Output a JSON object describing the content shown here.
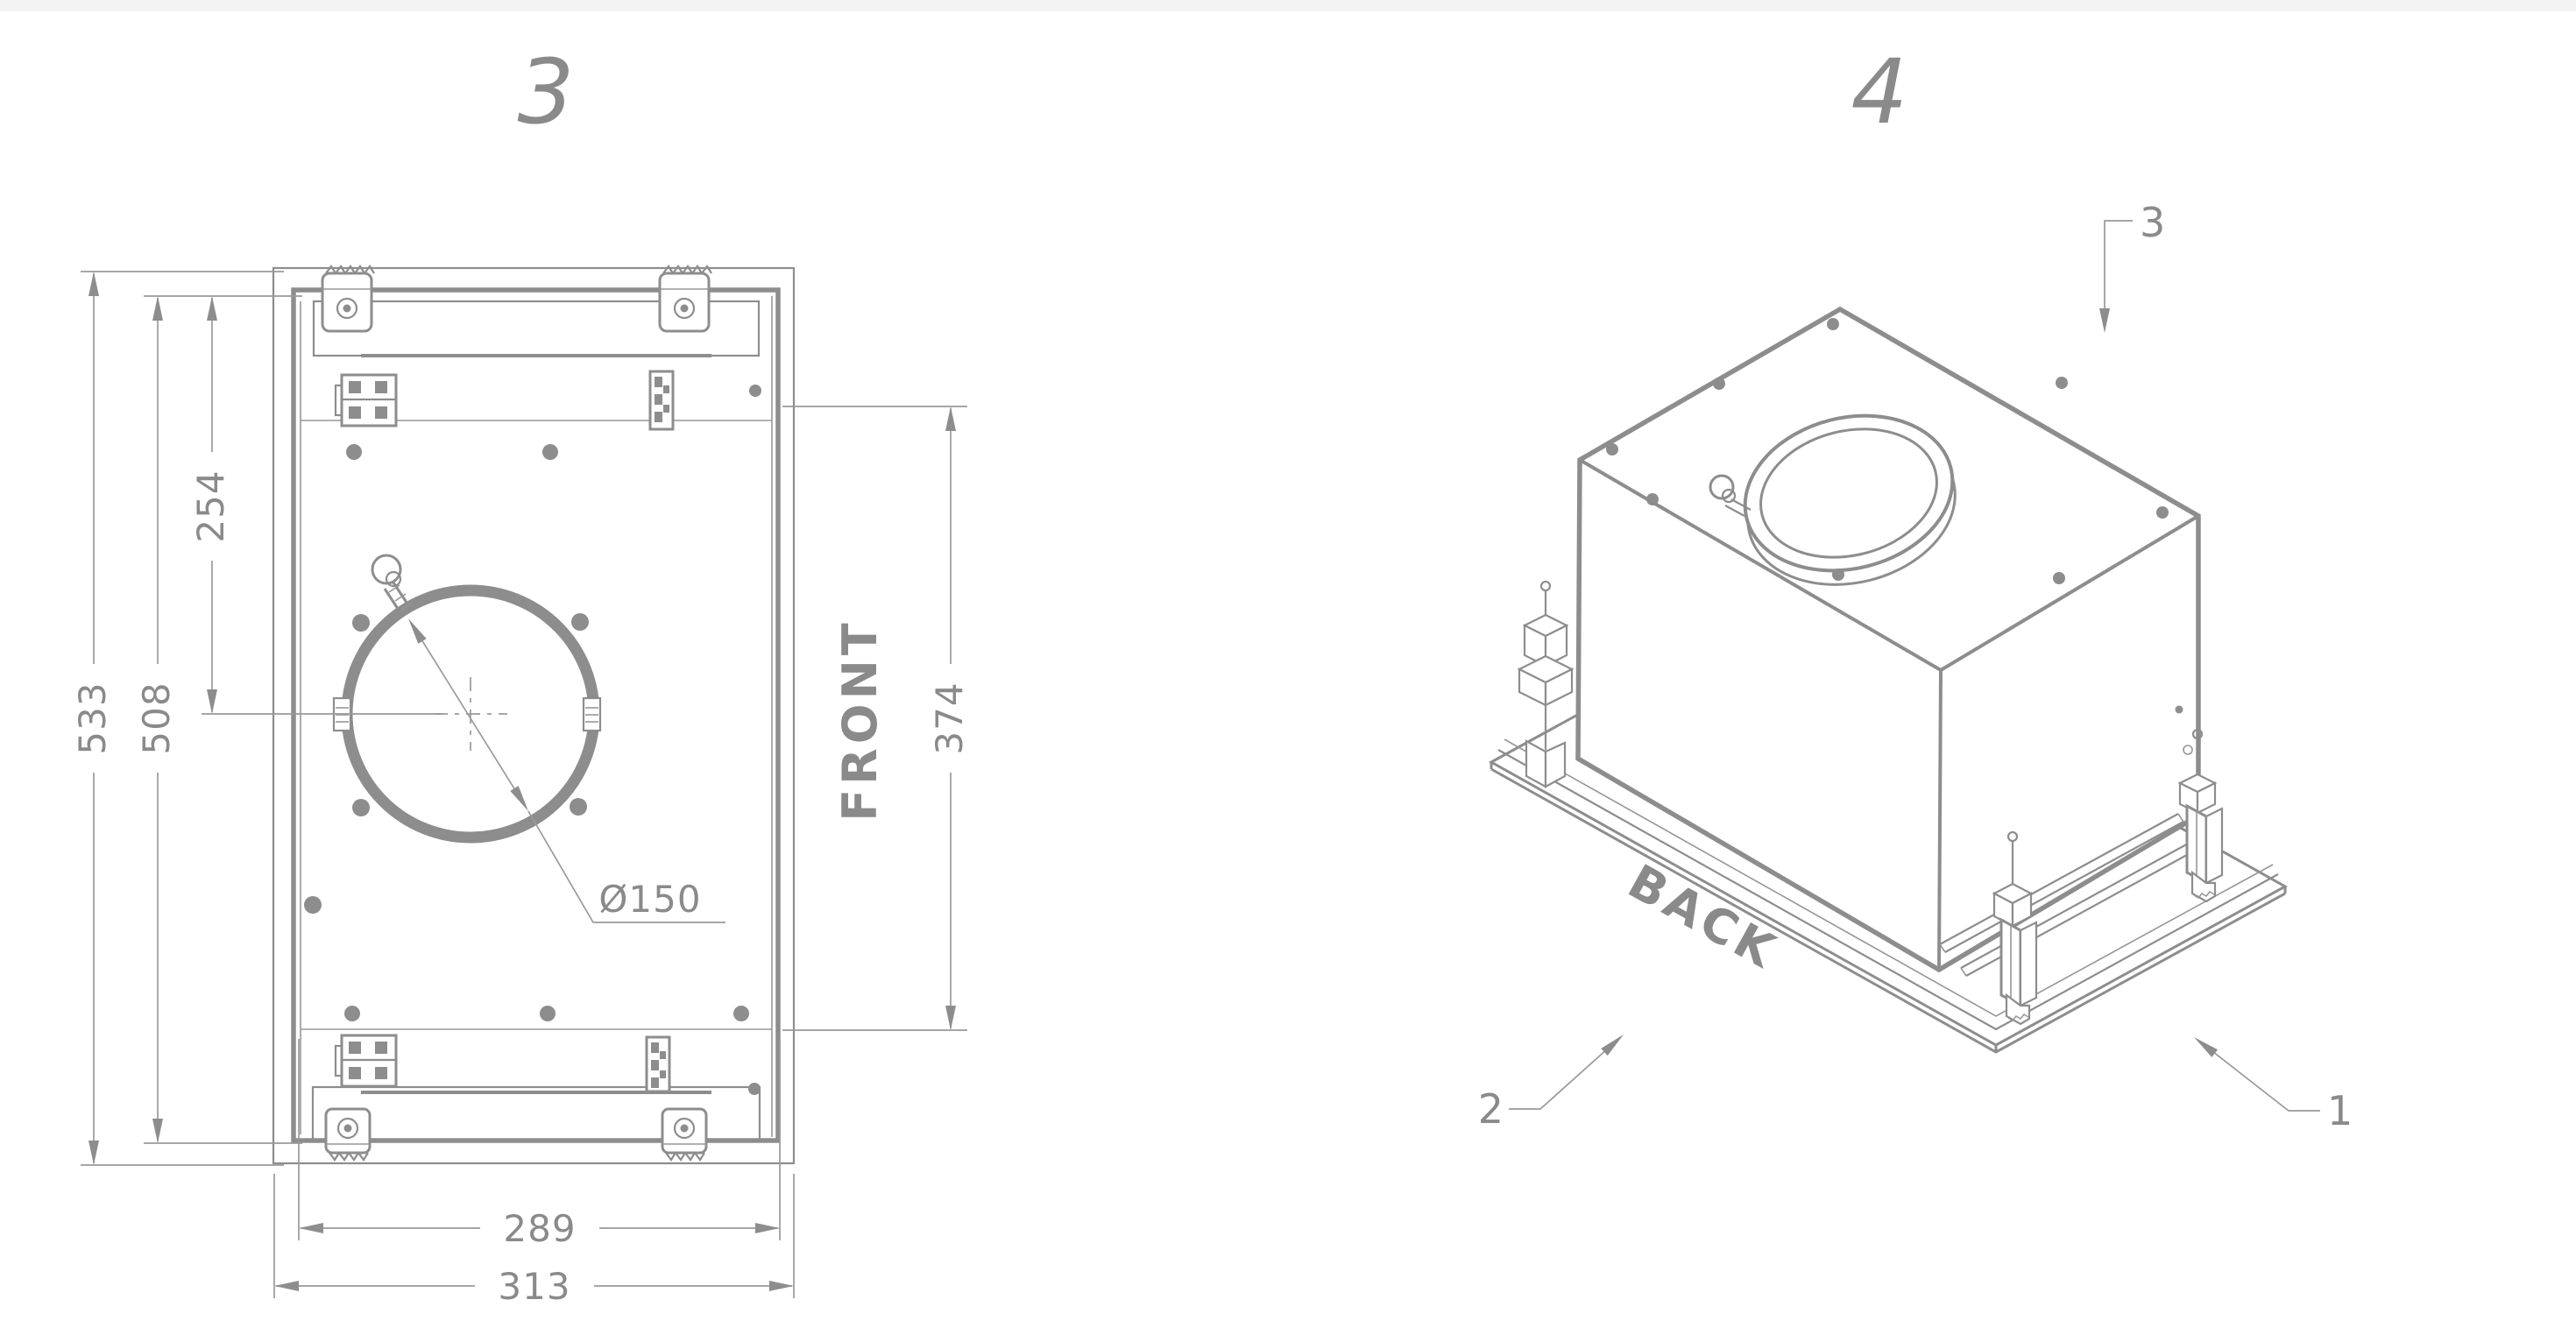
{
  "colors": {
    "background": "#ffffff",
    "line": "#8d8d8d",
    "dimension_line": "#9a9a9a",
    "text": "#8a8a8a",
    "top_strip": "#f3f3f4"
  },
  "plan_view": {
    "figure_number": "3",
    "orientation_label": "FRONT",
    "dims": {
      "overall_height": "533",
      "inner_height": "508",
      "duct_offset": "254",
      "front_depth": "374",
      "inner_width": "289",
      "overall_width": "313",
      "duct_diameter": "Ø150"
    }
  },
  "iso_view": {
    "figure_number": "4",
    "orientation_label": "BACK",
    "callouts": {
      "top": "3",
      "left": "2",
      "right": "1"
    }
  }
}
